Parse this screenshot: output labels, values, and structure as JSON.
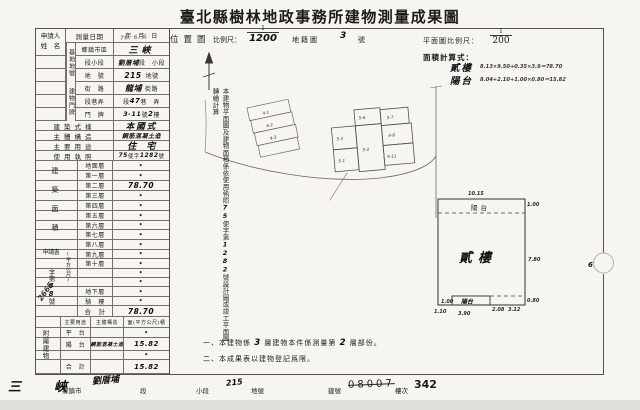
{
  "colors": {
    "paper": "#f6f5f1",
    "ink": "#1b1b18",
    "line": "#767167"
  },
  "title": "臺北縣樹林地政事務所建物測量成果圖",
  "left": {
    "applicant_line1": "申請人",
    "applicant_line2": "姓　名",
    "date_label": "測量日期",
    "date_printed": "年　月　日",
    "date_hw": "76. 6. 6",
    "site_group": "基地地號",
    "site_township_label": "鄉鎮市區",
    "site_township_hw": "三峽",
    "site_section_label": "段小段",
    "site_section_hw": "劉厝埔",
    "site_section_printed": "段　小段",
    "site_parcel_label": "地　號",
    "site_parcel_hw": "215",
    "site_parcel_printed": "地號",
    "door_group": "建物門牌",
    "door_street_label": "街　路",
    "door_street_hw": "龍埔",
    "door_street_printed": "街路",
    "door_lane_label": "段巷弄",
    "door_lane_pre": "段",
    "door_lane_hw": "47",
    "door_lane_post": "巷　弄",
    "door_number_label": "門　牌",
    "door_number_hw": "3-11",
    "door_number_mid": "號",
    "door_number_hw2": "2",
    "door_number_post": "樓",
    "style_label": "建築式樣",
    "style_hw": "本國式",
    "structure_label": "主體構造",
    "structure_hw": "鋼筋混凝土造",
    "usage_label": "主要用途",
    "usage_hw": "住　宅",
    "license_label": "使用執照",
    "license_hw1": "75",
    "license_mid": "使字",
    "license_hw2": "1282",
    "license_post": "號",
    "area_group": "建築面積",
    "area_unit": "(平方公尺)",
    "floors": [
      {
        "label": "地面層",
        "value": "•"
      },
      {
        "label": "第一層",
        "value": "•"
      },
      {
        "label": "第二層",
        "value": "78.70"
      },
      {
        "label": "第三層",
        "value": "•"
      },
      {
        "label": "第四層",
        "value": "•"
      },
      {
        "label": "第五層",
        "value": "•"
      },
      {
        "label": "第六層",
        "value": "•"
      },
      {
        "label": "第七層",
        "value": "•"
      },
      {
        "label": "第八層",
        "value": "•"
      },
      {
        "label": "第九層",
        "value": "•"
      },
      {
        "label": "第十層",
        "value": "•"
      },
      {
        "label": "",
        "value": "•"
      },
      {
        "label": "",
        "value": "•"
      },
      {
        "label": "地下層",
        "value": "•"
      },
      {
        "label": "騎　樓",
        "value": "•"
      }
    ],
    "total_label": "合　計",
    "total_value": "78.70",
    "application_label": "申請書",
    "application_no_1": "字第",
    "application_no_hw": "88",
    "application_no_2": "號",
    "application_side_hw": "2665",
    "annex_group": "附屬建物",
    "annex_h1": "主要用途",
    "annex_h2": "主體構造",
    "annex_h3": "面(平方公尺)積",
    "annex_rows": [
      {
        "c1": "平　台",
        "c2": "",
        "c3": "•"
      },
      {
        "c1": "陽　台",
        "c2": "鋼筋混凝土造",
        "c3": "15.82"
      },
      {
        "c1": "",
        "c2": "",
        "c3": "•"
      },
      {
        "c1": "合　計",
        "c2": "",
        "c3": "15.82"
      }
    ]
  },
  "strip": {
    "printed1": "本建物平面圖及建物面積係依使用執照",
    "hw1": "75",
    "printed2": "使字第",
    "hw2": "1282",
    "printed3": "號設計圖或竣工平面圖轉繪計算"
  },
  "map": {
    "section_label": "位置圖",
    "scale_label": "比例尺：",
    "scale_numerator": "1",
    "scale_denominator_hw": "1200",
    "sheet_label": "地籍圖",
    "sheet_no_hw": "3",
    "sheet_suffix": "號",
    "parcels": [
      "4-1",
      "4-2",
      "4-3",
      "5-6",
      "5-7",
      "5-3",
      "4-8",
      "5-2",
      "5-1",
      "5-11"
    ]
  },
  "plan": {
    "scale_label": "平面圖比例尺：",
    "scale_numerator": "1",
    "scale_denominator": "200",
    "calc_label": "面積計算式：",
    "calc1_name": "貳樓",
    "calc1_formula": "8.13×9.50+0.35×3.9＝78.70",
    "calc2_name": "陽台",
    "calc2_formula": "8.04+2.10+1.00×0.80＝15.82",
    "floor_label": "貳樓",
    "balcony_top": "陽台",
    "balcony_bottom": "陽台",
    "dim_top": "10.15",
    "dim_right_top": "1.00",
    "dim_right_mid": "7.80",
    "dim_right_bottom": "0.80",
    "dim_bottom_1": "1.10",
    "dim_bottom_2": "3.90",
    "dim_bottom_3": "2.08",
    "dim_bottom_4": "3.12",
    "dim_inner": "1.00",
    "road_hw": "6"
  },
  "notes": {
    "n1_pre": "一、本建物係",
    "n1_hw1": "3",
    "n1_mid": "層建物本件係測量第",
    "n1_hw2": "2",
    "n1_post": "層部份。",
    "n2": "二、本成果表以建物登記爲限。"
  },
  "footer": {
    "town_hw": "三　峽",
    "town_label": "鄉鎮市",
    "section_hw": "劉厝埔",
    "section_label": "段",
    "subsection_label": "小段",
    "parcel_hw": "215",
    "parcel_label": "地號",
    "building_label": "建號",
    "building_no": "08007",
    "floor_label": "樓次",
    "floor_no": "342"
  }
}
